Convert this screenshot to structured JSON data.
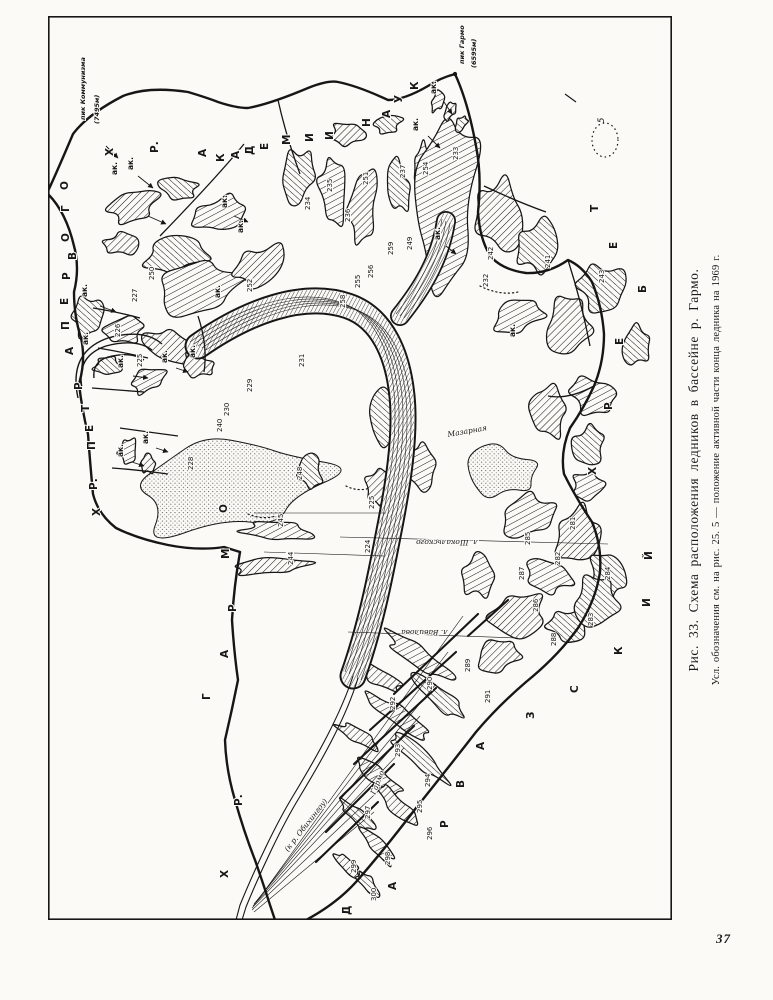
{
  "page_number": "37",
  "caption": {
    "title": "Рис. 33. Схема расположения ледников в бассейне р. Гармо.",
    "legend_note": "Усл. обозначения см. на рис. 25. 5 — положение активной части конца ледника на 1969 г."
  },
  "map": {
    "ink_color": "#161616",
    "paper_color": "#fbfaf6",
    "peaks": [
      {
        "name": "пик Коммунизма",
        "elevation": "(7495м)",
        "x": 37,
        "y": 104,
        "ex": 51,
        "ey": 108,
        "dot": false
      },
      {
        "name": "пик Гармо",
        "elevation": "(6595м)",
        "x": 416,
        "y": 48,
        "ex": 428,
        "ey": 52,
        "dot": true,
        "dx": 407,
        "dy": 58
      }
    ],
    "ridges": [
      {
        "id": "khrebet-akademii-nauk",
        "letters": [
          [
            "Х",
            65,
            140
          ],
          [
            "Р.",
            110,
            137
          ],
          [
            "А",
            158,
            141
          ],
          [
            "К",
            176,
            146
          ],
          [
            "А",
            191,
            143
          ],
          [
            "Д",
            205,
            139
          ],
          [
            "Е",
            220,
            134
          ],
          [
            "М",
            242,
            129
          ],
          [
            "И",
            265,
            126
          ],
          [
            "И",
            285,
            124
          ],
          [
            "Н",
            322,
            111
          ],
          [
            "А",
            342,
            102
          ],
          [
            "У",
            354,
            87
          ],
          [
            "К",
            370,
            74
          ]
        ]
      },
      {
        "id": "khrebet-petra-pervogo",
        "letters": [
          [
            "Х",
            52,
            500
          ],
          [
            "Р.",
            49,
            474
          ],
          [
            "П",
            47,
            434
          ],
          [
            "Е",
            45,
            416
          ],
          [
            "Т",
            41,
            396
          ],
          [
            "Р",
            34,
            374
          ],
          [
            "А",
            25,
            339
          ],
          [
            "П",
            21,
            314
          ],
          [
            "Е",
            20,
            289
          ],
          [
            "Р",
            22,
            264
          ],
          [
            "В",
            28,
            244
          ],
          [
            "О",
            21,
            226
          ],
          [
            "Г",
            21,
            196
          ],
          [
            "О",
            20,
            174
          ]
        ]
      },
      {
        "id": "khrebet-garmo",
        "letters": [
          [
            "Х",
            180,
            862
          ],
          [
            "Р.",
            194,
            790
          ],
          [
            "Г",
            162,
            684
          ],
          [
            "А",
            180,
            642
          ],
          [
            "Р",
            188,
            596
          ],
          [
            "М",
            181,
            543
          ],
          [
            "О",
            179,
            497
          ]
        ]
      },
      {
        "id": "darvazskiy-khrebet",
        "letters": [
          [
            "Д",
            302,
            899
          ],
          [
            "А",
            348,
            874
          ],
          [
            "Р",
            400,
            812
          ],
          [
            "В",
            416,
            772
          ],
          [
            "А",
            436,
            734
          ],
          [
            "З",
            486,
            703
          ],
          [
            "С",
            530,
            677
          ],
          [
            "К",
            574,
            639
          ],
          [
            "И",
            602,
            591
          ],
          [
            "Й",
            604,
            544
          ],
          [
            "Х",
            548,
            459
          ],
          [
            "Р",
            564,
            394
          ],
          [
            "Е",
            575,
            329
          ],
          [
            "Б",
            598,
            277
          ],
          [
            "Е",
            569,
            233
          ],
          [
            "Т",
            550,
            196
          ]
        ]
      }
    ],
    "glacier_numbers": [
      [
        "225",
        94,
        351
      ],
      [
        "226",
        72,
        321
      ],
      [
        "227",
        89,
        286
      ],
      [
        "250",
        106,
        264
      ],
      [
        "252",
        204,
        276
      ],
      [
        "228",
        145,
        454
      ],
      [
        "229",
        204,
        376
      ],
      [
        "230",
        181,
        400
      ],
      [
        "240",
        174,
        416
      ],
      [
        "231",
        256,
        351
      ],
      [
        "234",
        262,
        194
      ],
      [
        "235",
        284,
        176
      ],
      [
        "236",
        302,
        206
      ],
      [
        "237",
        357,
        162
      ],
      [
        "251",
        320,
        169
      ],
      [
        "254",
        380,
        159
      ],
      [
        "233",
        410,
        144
      ],
      [
        "242",
        445,
        244
      ],
      [
        "241",
        502,
        252
      ],
      [
        "232",
        440,
        271
      ],
      [
        "243",
        556,
        267
      ],
      [
        "255",
        312,
        272
      ],
      [
        "256",
        325,
        262
      ],
      [
        "258",
        297,
        292
      ],
      [
        "259",
        345,
        239
      ],
      [
        "249",
        364,
        234
      ],
      [
        "244",
        245,
        549
      ],
      [
        "245",
        235,
        511
      ],
      [
        "224",
        322,
        537
      ],
      [
        "225",
        326,
        493
      ],
      [
        "248",
        254,
        464
      ],
      [
        "281",
        527,
        514
      ],
      [
        "282",
        512,
        549
      ],
      [
        "283",
        545,
        610
      ],
      [
        "284",
        562,
        564
      ],
      [
        "285",
        482,
        529
      ],
      [
        "286",
        490,
        596
      ],
      [
        "287",
        476,
        564
      ],
      [
        "288",
        508,
        630
      ],
      [
        "289",
        422,
        656
      ],
      [
        "290",
        384,
        674
      ],
      [
        "291",
        442,
        687
      ],
      [
        "292",
        347,
        694
      ],
      [
        "293",
        352,
        741
      ],
      [
        "294",
        382,
        771
      ],
      [
        "295",
        374,
        797
      ],
      [
        "296",
        384,
        824
      ],
      [
        "297",
        322,
        803
      ],
      [
        "298",
        342,
        849
      ],
      [
        "299",
        308,
        857
      ],
      [
        "300",
        328,
        885
      ]
    ],
    "ak_text": "ак.",
    "ak_labels": [
      [
        69,
        159
      ],
      [
        85,
        154
      ],
      [
        179,
        192
      ],
      [
        195,
        217
      ],
      [
        39,
        281
      ],
      [
        172,
        282
      ],
      [
        40,
        329
      ],
      [
        75,
        352
      ],
      [
        119,
        347
      ],
      [
        147,
        342
      ],
      [
        75,
        441
      ],
      [
        100,
        428
      ],
      [
        370,
        115
      ],
      [
        388,
        78
      ],
      [
        467,
        321
      ],
      [
        392,
        224
      ]
    ],
    "names": [
      {
        "text": "Гармо",
        "x": 327,
        "y": 779,
        "rot": -68
      },
      {
        "text": "(к р. Обихингоу)",
        "x": 240,
        "y": 836,
        "rot": -52
      },
      {
        "text": "Мазарная",
        "x": 400,
        "y": 421,
        "rot": -10
      },
      {
        "text": "л. Шокальского",
        "x": 430,
        "y": 524,
        "rot": 180
      },
      {
        "text": "л. Вавилова",
        "x": 400,
        "y": 614,
        "rot": 180
      }
    ],
    "legend_mark": {
      "label": "5",
      "x": 556,
      "y": 107,
      "cx": 557,
      "cy": 124
    }
  }
}
